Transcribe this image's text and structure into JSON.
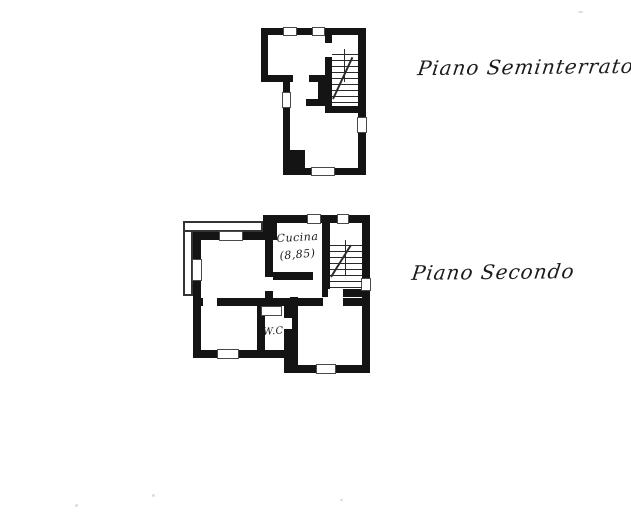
{
  "document": {
    "kind": "scanned floor plan sheet",
    "language": "Italian"
  },
  "floors": [
    {
      "name": "seminterrato",
      "title": "Piano Seminterrato"
    },
    {
      "name": "secondo",
      "title": "Piano Secondo",
      "rooms": [
        {
          "label": "Cucina",
          "area": "(8,85)"
        },
        {
          "label": "W.C."
        }
      ]
    }
  ],
  "colors": {
    "wall": "#141414",
    "ink": "#1b1b1b",
    "paper": "#ffffff",
    "wout": "#4a4a4a",
    "tread": "#2a2a2a"
  }
}
